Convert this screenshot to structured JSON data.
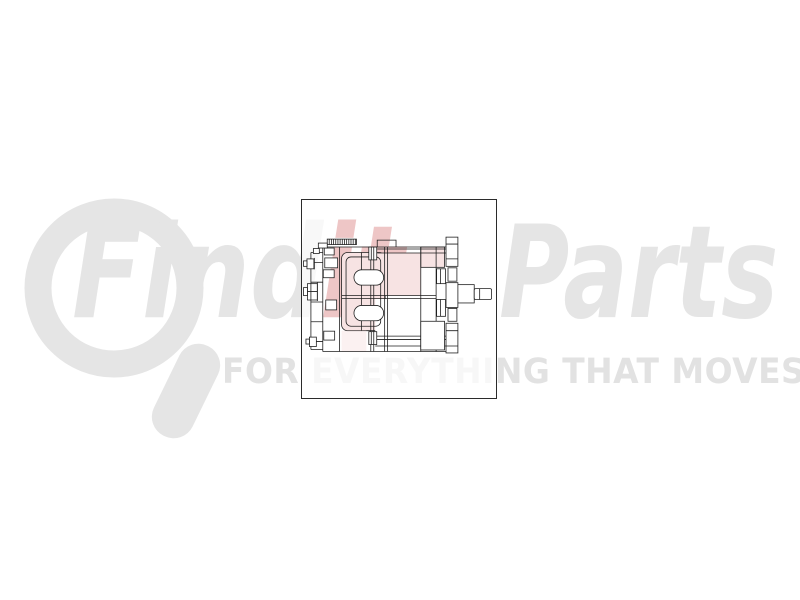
{
  "watermark": {
    "brand_prefix": "Find",
    "brand_mid": "it",
    "brand_suffix": "Parts",
    "tagline": "FOR EVERYTHING THAT MOVES",
    "logo": "magnifying-glass"
  },
  "colors": {
    "page_background": "#ffffff",
    "watermark_gray": "#e5e5e5",
    "watermark_red": "#c03434",
    "tagline_gray": "#e2e2e2",
    "drawing_line": "#1f1f1f",
    "drawing_highlight": "#f7e3e3",
    "frame_border": "#2b2b2b"
  },
  "product_image": {
    "description": "Technical side-view line drawing of a heavy-duty alternator: rear bracket with terminal studs and bolts on the left, end plate with two rounded slot cutouts, finned stator body, front mounting flange with ears, and a stepped output shaft protruding to the right; some faces shaded light red"
  }
}
